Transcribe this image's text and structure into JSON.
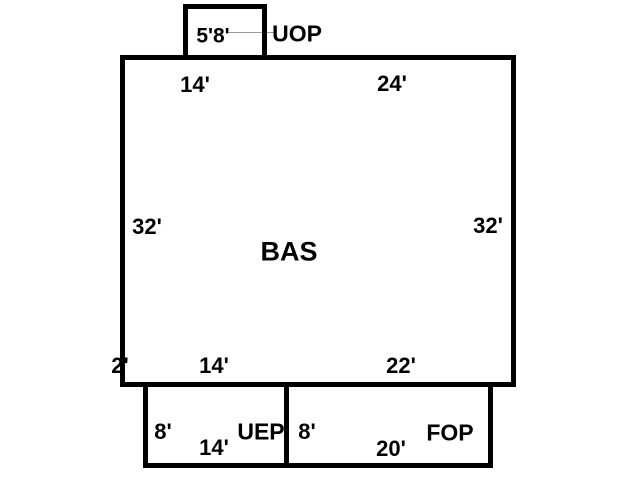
{
  "diagram": {
    "type": "floor-plan-sketch",
    "background_color": "#ffffff",
    "line_color": "#000000",
    "leader_line_color": "#9a9a9a",
    "areas": {
      "bas": {
        "name": "BAS"
      },
      "uop": {
        "name": "UOP"
      },
      "uep": {
        "name": "UEP"
      },
      "fop": {
        "name": "FOP"
      }
    },
    "labels": {
      "uop_dim": "5'8'",
      "uop_name": "UOP",
      "bas_top_left_dim": "14'",
      "bas_top_right_dim": "24'",
      "bas_left_dim": "32'",
      "bas_right_dim": "32'",
      "bas_name": "BAS",
      "bas_bottom_corner_dim": "2'",
      "bas_bottom_left_dim": "14'",
      "bas_bottom_right_dim": "22'",
      "uep_height_dim": "8'",
      "uep_width_dim": "14'",
      "uep_name": "UEP",
      "fop_height_dim": "8'",
      "fop_width_dim": "20'",
      "fop_name": "FOP"
    }
  }
}
